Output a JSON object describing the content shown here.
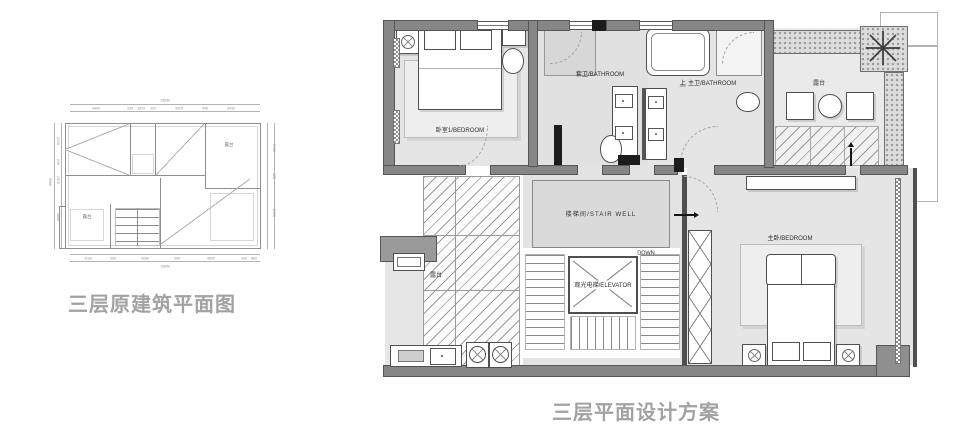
{
  "captions": {
    "left": "三层原建筑平面图",
    "right": "三层平面设计方案"
  },
  "left_plan": {
    "rooms": {
      "terrace_top_right": "露台",
      "terrace_bottom_left": "露台"
    },
    "dims": {
      "top_total": "13640",
      "top": [
        "4400",
        "230",
        "1470",
        "220",
        "3420",
        "240",
        "3430"
      ],
      "bottom": [
        "3190",
        "230",
        "4260",
        "240",
        "4540",
        "230",
        "860"
      ],
      "bottom_total": "13640",
      "left": [
        "2710",
        "220",
        "2370",
        "2880"
      ],
      "left_total": "9080",
      "right": [
        "3700",
        "220",
        "5150"
      ]
    }
  },
  "right_plan": {
    "labels": {
      "bedroom1": "卧室1/BEDROOM",
      "bath1": "套卫/BATHROOM",
      "up": "上",
      "bath2": "主卫/BATHROOM",
      "terrace_top": "露台",
      "terrace_left": "露台",
      "stair_well": "楼梯间/STAIR WELL",
      "down": "DOWN",
      "elevator": "观光电梯/ELEVATOR",
      "master": "主卧/BEDROOM"
    }
  },
  "colors": {
    "wall": "#868686",
    "wall_dark": "#4a4a4a",
    "floor": "#e5e5e5",
    "caption": "#a2a2a2"
  }
}
